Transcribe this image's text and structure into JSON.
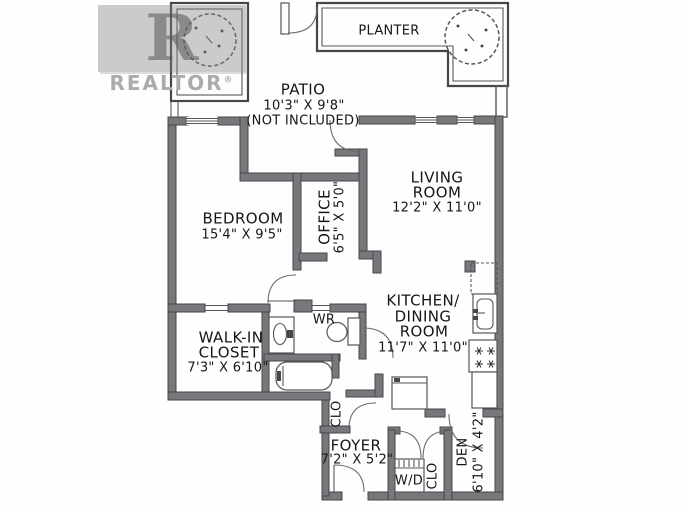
{
  "watermark": {
    "logo_letter": "R",
    "label": "REALTOR",
    "reg": "®"
  },
  "outdoor": {
    "planter_label": "PLANTER",
    "patio": {
      "name": "PATIO",
      "dims": "10'3\" X 9'8\"",
      "note": "(NOT INCLUDED)"
    }
  },
  "rooms": {
    "living": {
      "line1": "LIVING",
      "line2": "ROOM",
      "dims": "12'2\" X 11'0\""
    },
    "bedroom": {
      "name": "BEDROOM",
      "dims": "15'4\" X 9'5\""
    },
    "office": {
      "name": "OFFICE",
      "dims": "6'5\" X 5'0\""
    },
    "kitchen": {
      "line1": "KITCHEN/",
      "line2": "DINING",
      "line3": "ROOM",
      "dims": "11'7\" X 11'0\""
    },
    "walkin": {
      "line1": "WALK-IN",
      "line2": "CLOSET",
      "dims": "7'3\" X 6'10\""
    },
    "washroom": {
      "name": "WR"
    },
    "foyer": {
      "name": "FOYER",
      "dims": "7'2\" X 5'2\""
    },
    "den": {
      "name": "DEN",
      "dims": "6'10\" X 4'2\""
    },
    "closet_foyer": {
      "name": "CLO"
    },
    "closet_laundry": {
      "name": "CLO"
    },
    "laundry": {
      "name": "W/D"
    }
  },
  "colors": {
    "wall": "#77787b",
    "line": "#55565a",
    "text": "#161617",
    "watermark": "#ababab",
    "background": "#fefefe"
  }
}
